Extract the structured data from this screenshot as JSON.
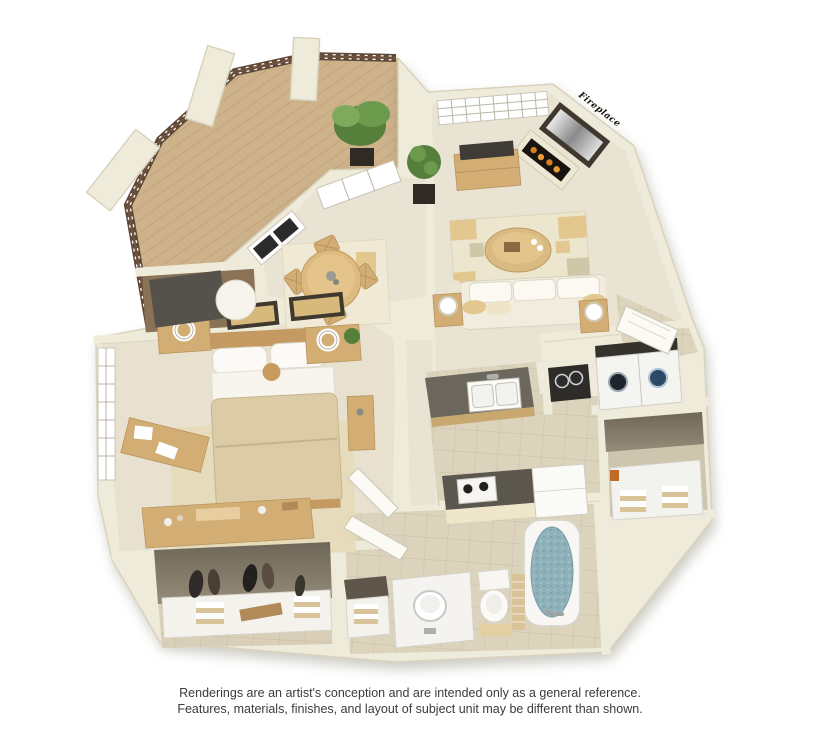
{
  "plan": {
    "fireplace_label": "Fireplace"
  },
  "disclaimer": {
    "line1": "Renderings are an artist's conception and are intended only as a general reference.",
    "line2": "Features, materials, finishes, and layout of subject unit may be different than shown."
  },
  "palette": {
    "background": "#FFFFFF",
    "wall": "#EFEBDA",
    "wall_edge": "#D8D3BD",
    "carpet": "#E9E3D3",
    "bedroom_carpet": "#E8E1CF",
    "tile": "#DCD3BD",
    "deck_wood": "#CDB28A",
    "furniture_wood": "#D3AE74",
    "rug_tan": "#E2C78F",
    "counter_dark": "#6B675D",
    "sofa_cream": "#F1ECDD",
    "tub_water": "#8FB2BA",
    "railing_brown": "#5F4938",
    "plant_green": "#567F3B",
    "text": "#3B3B3B"
  }
}
